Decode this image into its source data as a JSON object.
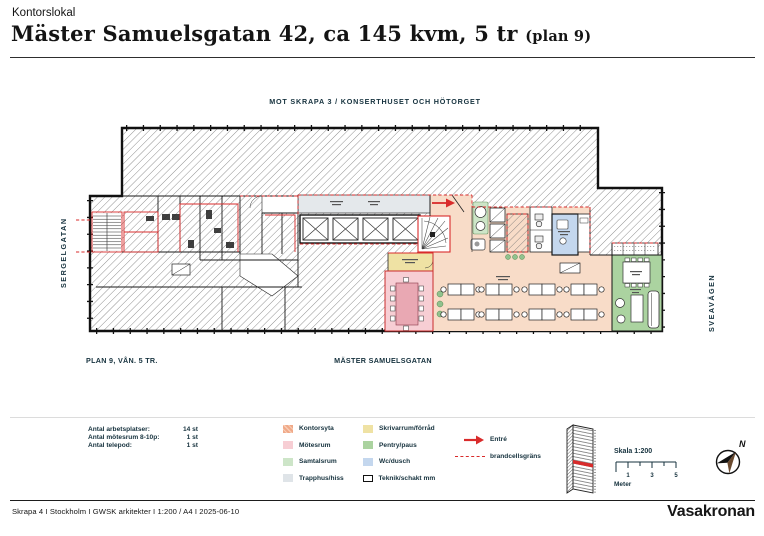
{
  "header": {
    "category": "Kontorslokal",
    "title": "Mäster Samuelsgatan 42, ca 145 kvm, 5 tr",
    "title_suffix": "(plan 9)"
  },
  "plan": {
    "label_top": "MOT SKRAPA 3 / KONSERTHUSET OCH HÖTORGET",
    "street_left": "SERGELGATAN",
    "street_right": "SVEAVÄGEN",
    "label_plan": "PLAN 9, VÅN. 5 TR.",
    "street_bottom": "MÄSTER SAMUELSGATAN"
  },
  "stats": {
    "rows": [
      {
        "label": "Antal arbetsplatser:",
        "value": "14 st"
      },
      {
        "label": "Antal mötesrum 8-10p:",
        "value": "1 st"
      },
      {
        "label": "Antal telepod:",
        "value": "1 st"
      }
    ]
  },
  "legend": {
    "col1": [
      {
        "label": "Kontorsyta",
        "color": "#F0A988"
      },
      {
        "label": "Mötesrum",
        "color": "#F7CED4"
      },
      {
        "label": "Samtalsrum",
        "color": "#CDE5C8"
      },
      {
        "label": "Trapphus/hiss",
        "color": "#DFE4E8"
      }
    ],
    "col2": [
      {
        "label": "Skrivarrum/förråd",
        "color": "#EFE2A4"
      },
      {
        "label": "Pentry/paus",
        "color": "#ABD3A0"
      },
      {
        "label": "Wc/dusch",
        "color": "#C4D7EE"
      },
      {
        "label": "Teknik/schakt mm",
        "color": "#FFFFFF"
      }
    ],
    "entry_label": "Entré",
    "firewall_label": "brandcellsgräns",
    "scale_title": "Skala 1:200",
    "scale_ticks": [
      "1",
      "3",
      "5"
    ],
    "scale_unit": "Meter",
    "north_label": "N"
  },
  "footer": {
    "info": "Skrapa 4 I Stockholm I GWSK arkitekter I 1:200 / A4 I 2025-06-10",
    "brand": "Vasakronan"
  },
  "colors": {
    "accent_red": "#D92B2B",
    "label_ink": "#16323E",
    "wall_ink": "#1a1a1a",
    "kontorsyta_plan": "#F8DCC8",
    "trapphus_gray": "#E4E8EB",
    "hatch_line": "#6e6e6e"
  }
}
